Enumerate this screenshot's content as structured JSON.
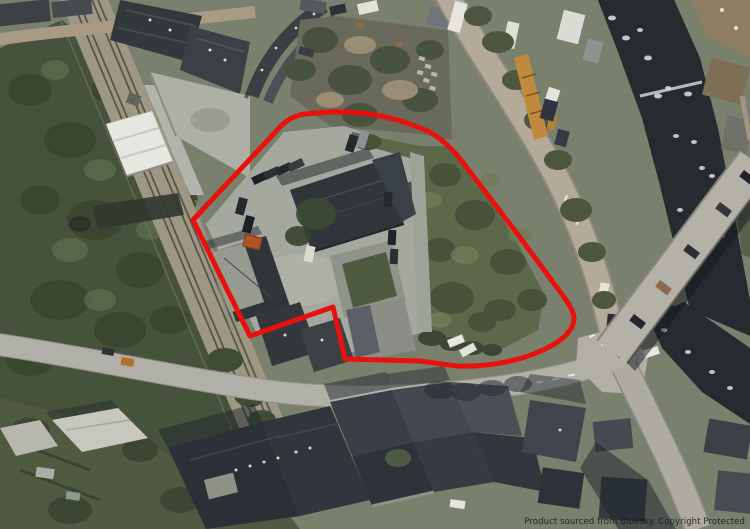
{
  "attribution": {
    "text": "Product sourced from Bluesky. Copyright Protected"
  },
  "overlay": {
    "boundary_path": "M 193 220 L 281 126 Q 291 116 305 114 L 330 112 Q 372 111 407 123 L 428 131 Q 447 142 461 160 L 516 232 Q 541 266 561 293 Q 574 310 574 318 Q 574 331 556 343 Q 535 356 506 362 Q 481 367 457 366 L 420 361 L 345 359 L 333 307 L 250 336 Z",
    "boundary_color": "#e8110d",
    "boundary_width": "5"
  }
}
